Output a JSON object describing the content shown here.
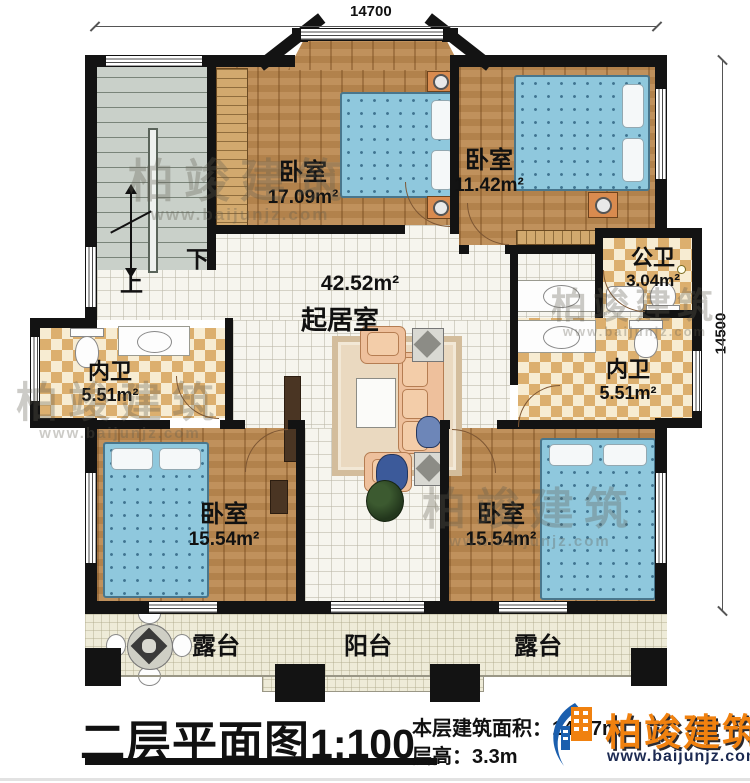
{
  "dimensions": {
    "top": "14700",
    "right": "14500"
  },
  "stairs": {
    "up": "上",
    "down": "下"
  },
  "rooms": {
    "bedroom_tl": {
      "name": "卧室",
      "area": "17.09m²"
    },
    "bedroom_tr": {
      "name": "卧室",
      "area": "11.42m²"
    },
    "public_bath": {
      "name": "公卫",
      "area": "3.04m²"
    },
    "living": {
      "name": "起居室",
      "area": "42.52m²"
    },
    "ensuite_left": {
      "name": "内卫",
      "area": "5.51m²"
    },
    "ensuite_right": {
      "name": "内卫",
      "area": "5.51m²"
    },
    "bedroom_bl": {
      "name": "卧室",
      "area": "15.54m²"
    },
    "bedroom_br": {
      "name": "卧室",
      "area": "15.54m²"
    },
    "terrace_left": {
      "name": "露台"
    },
    "balcony": {
      "name": "阳台"
    },
    "terrace_right": {
      "name": "露台"
    }
  },
  "titleblock": {
    "plan_title": "二层平面图",
    "scale": "1:100",
    "area_label": "本层建筑面积：",
    "area_value": "145.7m²",
    "height_label": "层高：",
    "height_value": "3.3m"
  },
  "brand": {
    "name": "柏竣建筑",
    "site": "www.baijunjz.com"
  },
  "colors": {
    "wall": "#131313",
    "bed_blue": "#8fc8dd",
    "wood": "#bb8950",
    "tile_dark": "#dcaf6e",
    "tile_light": "#f7ecd2",
    "brand_orange": "#f0810f",
    "brand_navy": "#1c2a52"
  }
}
